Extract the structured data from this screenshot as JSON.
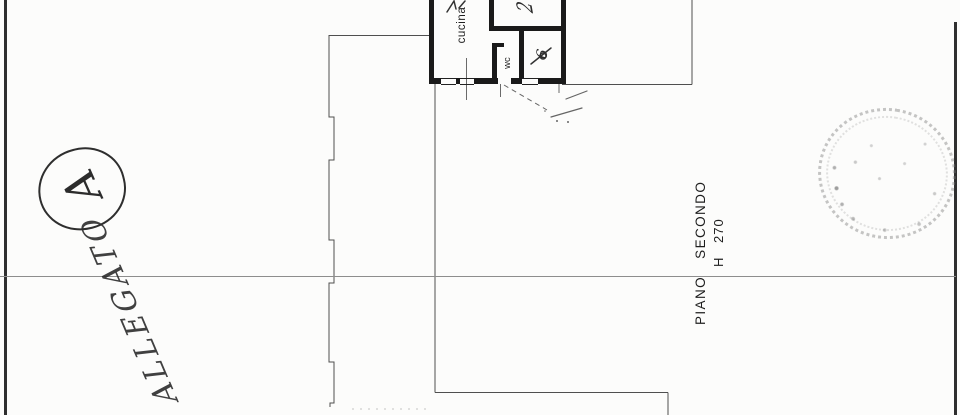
{
  "labels": {
    "kitchen": "cucina",
    "wc": "wc"
  },
  "floor_caption": {
    "title": "PIANO SECONDO",
    "height": "H 270"
  },
  "handwriting": {
    "attachment_word": "ALLEGATO",
    "attachment_letter": "A",
    "upper_room_mark": "2",
    "side_room_mark": "6"
  },
  "colors": {
    "wall_ink": "#1a1a1a",
    "thin_line": "#4f4f4f",
    "page_border": "#2f2f2f",
    "stamp_gray": "#9a9a9a",
    "paper": "#fcfcfb"
  }
}
